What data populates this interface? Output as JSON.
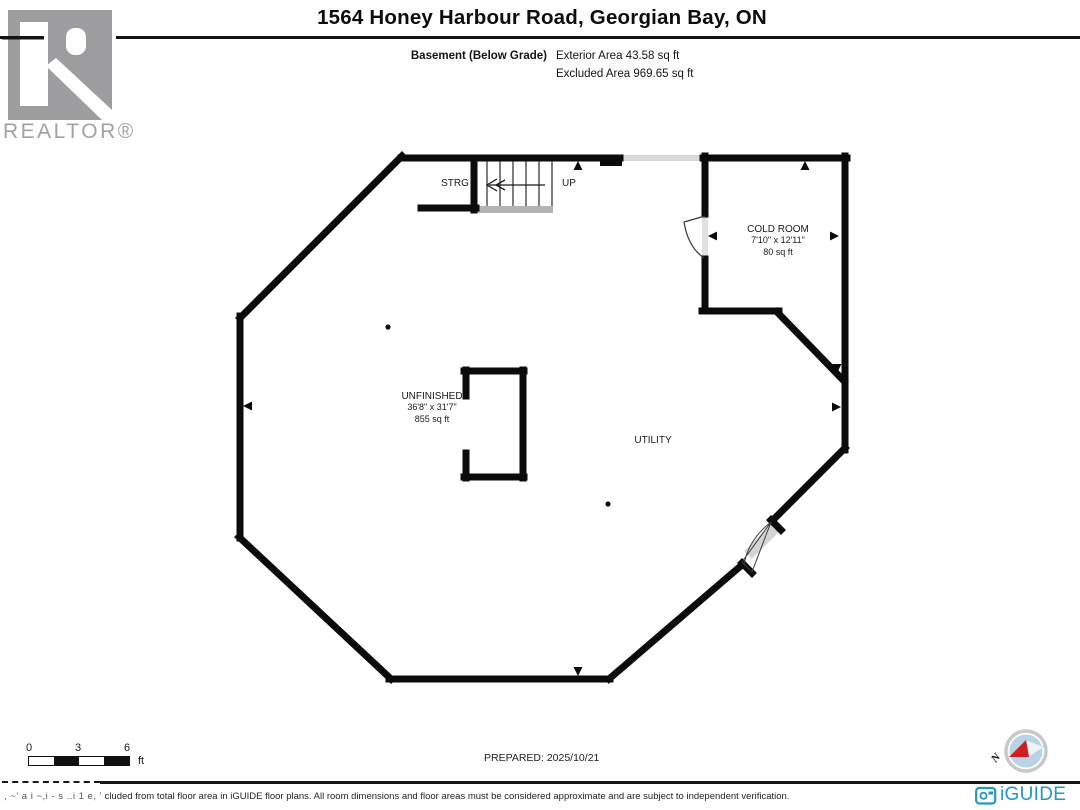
{
  "header": {
    "title": "1564 Honey Harbour Road, Georgian Bay, ON",
    "floor_label": "Basement (Below Grade)",
    "exterior_area": "Exterior Area 43.58 sq ft",
    "excluded_area": "Excluded Area 969.65 sq ft"
  },
  "branding": {
    "realtor_logo_text": "REALTOR®",
    "iguide_logo_text": "iGUIDE",
    "iguide_blue": "#2596be",
    "realtor_gray": "#9d9d9f"
  },
  "floor_plan": {
    "rooms": [
      {
        "name": "STRG"
      },
      {
        "name": "UP"
      },
      {
        "name": "COLD ROOM",
        "dimensions": "7'10\" x 12'11\"",
        "area": "80 sq ft"
      },
      {
        "name": "UNFINISHED",
        "dimensions": "36'8\" x 31'7\"",
        "area": "855 sq ft"
      },
      {
        "name": "UTILITY"
      }
    ]
  },
  "footer": {
    "scale": {
      "tick0": "0",
      "tick1": "3",
      "tick2": "6",
      "unit": "ft"
    },
    "prepared": "PREPARED: 2025/10/21",
    "disclaimer_garbled": ", ~' a i ~,i - s ..i 1 e, '",
    "disclaimer": "cluded from total floor area in iGUIDE floor plans. All room dimensions and floor areas must be considered approximate and are subject to independent verification.",
    "compass_label": "N"
  }
}
